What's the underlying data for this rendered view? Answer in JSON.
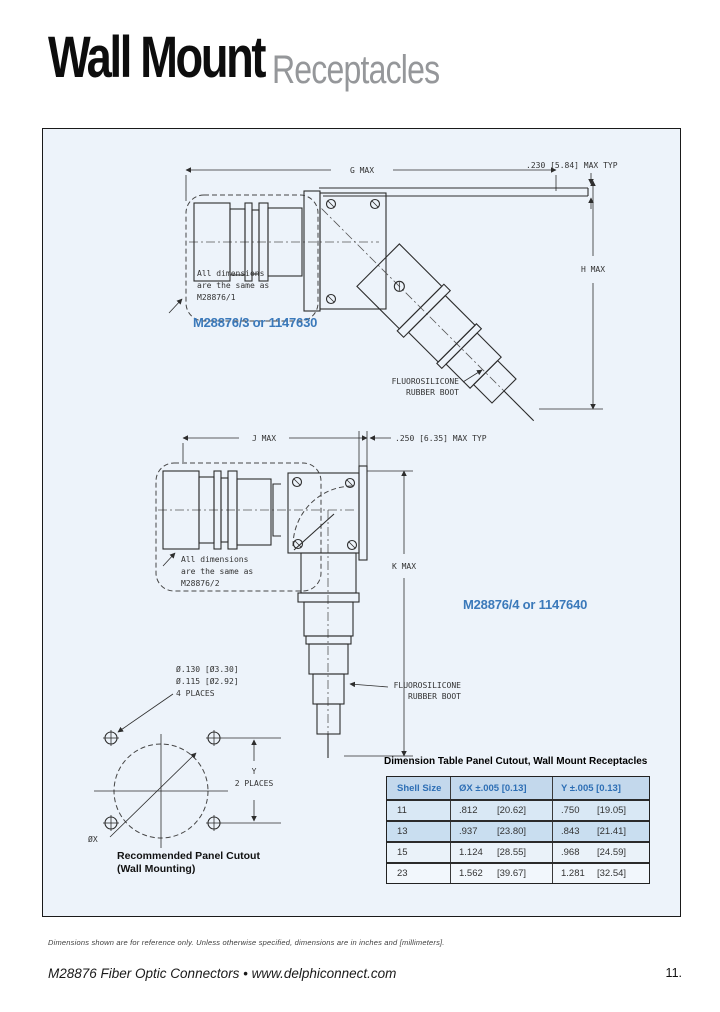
{
  "page": {
    "title_black": "Wall Mount",
    "title_gray": "Receptacles",
    "footer_note": "Dimensions shown are for reference only.  Unless otherwise specified, dimensions are in inches and [millimeters].",
    "footer_brand": "M28876 Fiber Optic Connectors  •  www.delphiconnect.com",
    "page_number": "11."
  },
  "drawing_top": {
    "part_label": "M28876/3 or 1147630",
    "dim_width": "G MAX",
    "dim_height": "H MAX",
    "flange_callout": ".230 [5.84] MAX TYP",
    "note_line1": "All dimensions",
    "note_line2": "are the same as",
    "note_line3": "M28876/1",
    "boot_line1": "FLUOROSILICONE",
    "boot_line2": "RUBBER BOOT"
  },
  "drawing_mid": {
    "part_label": "M28876/4 or 1147640",
    "dim_width": "J MAX",
    "dim_height": "K MAX",
    "flange_callout": ".250 [6.35] MAX TYP",
    "note_line1": "All dimensions",
    "note_line2": "are the same as",
    "note_line3": "M28876/2",
    "boot_line1": "FLUOROSILICONE",
    "boot_line2": "RUBBER BOOT"
  },
  "cutout": {
    "hole_line1": "Ø.130 [Ø3.30]",
    "hole_line2": "Ø.115 [Ø2.92]",
    "hole_line3": "4 PLACES",
    "y_label": "Y",
    "y_places": "2 PLACES",
    "x_label": "ØX",
    "caption_line1": "Recommended Panel Cutout",
    "caption_line2": "(Wall Mounting)"
  },
  "table": {
    "title": "Dimension Table Panel Cutout, Wall Mount Receptacles",
    "headers": [
      "Shell Size",
      "ØX ±.005 [0.13]",
      "Y ±.005 [0.13]"
    ],
    "rows": [
      {
        "shell": "11",
        "x_in": ".812",
        "x_mm": "[20.62]",
        "y_in": ".750",
        "y_mm": "[19.05]"
      },
      {
        "shell": "13",
        "x_in": ".937",
        "x_mm": "[23.80]",
        "y_in": ".843",
        "y_mm": "[21.41]"
      },
      {
        "shell": "15",
        "x_in": "1.124",
        "x_mm": "[28.55]",
        "y_in": ".968",
        "y_mm": "[24.59]"
      },
      {
        "shell": "23",
        "x_in": "1.562",
        "x_mm": "[39.67]",
        "y_in": "1.281",
        "y_mm": "[32.54]"
      }
    ]
  },
  "colors": {
    "accent_blue": "#3b79ba",
    "panel_bg": "#edf3fa",
    "table_header_bg": "#c3d8ec",
    "line": "#2d2d2d"
  }
}
